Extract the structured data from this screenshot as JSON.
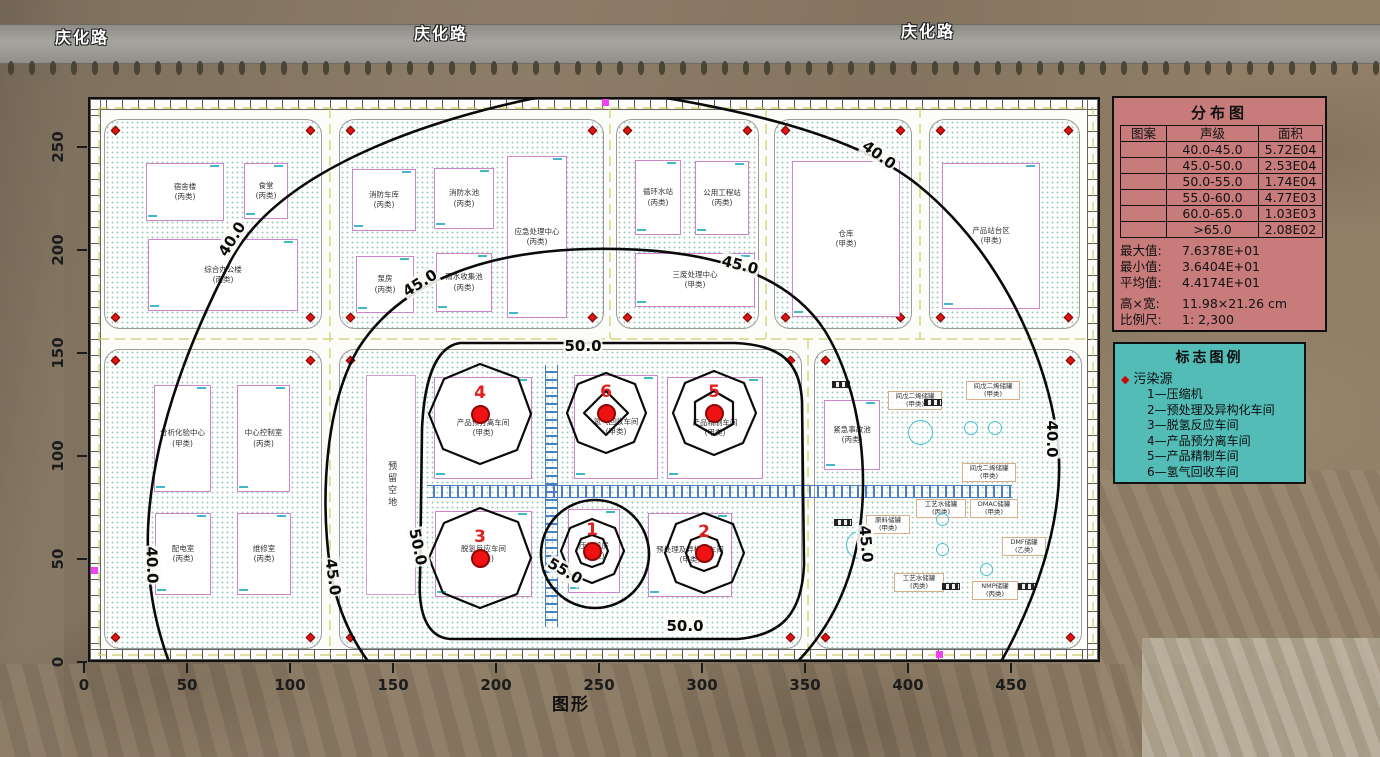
{
  "road_labels": [
    {
      "text": "庆化路",
      "x": 55,
      "y": 24
    },
    {
      "text": "庆化路",
      "x": 414,
      "y": 20
    },
    {
      "text": "庆化路",
      "x": 901,
      "y": 18
    }
  ],
  "axes": {
    "x_ticks": [
      0,
      50,
      100,
      150,
      200,
      250,
      300,
      350,
      400,
      450
    ],
    "y_ticks": [
      0,
      50,
      100,
      150,
      200,
      250
    ],
    "x_title": "图形"
  },
  "distribution": {
    "title": "分布图",
    "headers": [
      "图案",
      "声级",
      "面积"
    ],
    "rows": [
      {
        "pattern": "",
        "level": "40.0-45.0",
        "area": "5.72E04"
      },
      {
        "pattern": "",
        "level": "45.0-50.0",
        "area": "2.53E04"
      },
      {
        "pattern": "",
        "level": "50.0-55.0",
        "area": "1.74E04"
      },
      {
        "pattern": "",
        "level": "55.0-60.0",
        "area": "4.77E03"
      },
      {
        "pattern": "",
        "level": "60.0-65.0",
        "area": "1.03E03"
      },
      {
        "pattern": "",
        "level": ">65.0",
        "area": "2.08E02"
      }
    ],
    "stats": [
      {
        "label": "最大值:",
        "value": "7.6378E+01"
      },
      {
        "label": "最小值:",
        "value": "3.6404E+01"
      },
      {
        "label": "平均值:",
        "value": "4.4174E+01"
      }
    ],
    "dims": [
      {
        "label": "高×宽:",
        "value": "11.98×21.26 cm"
      },
      {
        "label": "比例尺:",
        "value": "1: 2,300"
      }
    ]
  },
  "marker_legend": {
    "title": "标志图例",
    "group": "污染源",
    "items": [
      "1—压缩机",
      "2—预处理及异构化车间",
      "3—脱氢反应车间",
      "4—产品预分离车间",
      "5—产品精制车间",
      "6—氢气回收车间"
    ]
  },
  "map": {
    "contour_labels": [
      {
        "text": "40.0",
        "x": 142,
        "y": 140,
        "rot": -58
      },
      {
        "text": "45.0",
        "x": 330,
        "y": 184,
        "rot": -32
      },
      {
        "text": "40.0",
        "x": 789,
        "y": 56,
        "rot": 36
      },
      {
        "text": "45.0",
        "x": 650,
        "y": 166,
        "rot": 14
      },
      {
        "text": "50.0",
        "x": 493,
        "y": 247,
        "rot": 0
      },
      {
        "text": "50.0",
        "x": 595,
        "y": 527,
        "rot": 0
      },
      {
        "text": "50.0",
        "x": 328,
        "y": 448,
        "rot": 78
      },
      {
        "text": "55.0",
        "x": 475,
        "y": 472,
        "rot": 30
      },
      {
        "text": "45.0",
        "x": 243,
        "y": 478,
        "rot": 82
      },
      {
        "text": "40.0",
        "x": 62,
        "y": 466,
        "rot": 88
      },
      {
        "text": "45.0",
        "x": 776,
        "y": 445,
        "rot": 85
      },
      {
        "text": "40.0",
        "x": 962,
        "y": 340,
        "rot": 90
      }
    ],
    "sources": [
      {
        "id": "4",
        "x": 390,
        "y": 315
      },
      {
        "id": "6",
        "x": 516,
        "y": 314
      },
      {
        "id": "5",
        "x": 624,
        "y": 314
      },
      {
        "id": "3",
        "x": 390,
        "y": 459
      },
      {
        "id": "1",
        "x": 502,
        "y": 452
      },
      {
        "id": "2",
        "x": 614,
        "y": 454
      }
    ],
    "buildings": [
      {
        "name": "宿舍楼",
        "cls": "(丙类)",
        "x": 56,
        "y": 64,
        "w": 78,
        "h": 58,
        "kind": "b"
      },
      {
        "name": "食堂",
        "cls": "(丙类)",
        "x": 154,
        "y": 64,
        "w": 44,
        "h": 56,
        "kind": "b"
      },
      {
        "name": "综合办公楼",
        "cls": "(丙类)",
        "x": 58,
        "y": 140,
        "w": 150,
        "h": 72,
        "kind": "b"
      },
      {
        "name": "消防车库",
        "cls": "(丙类)",
        "x": 262,
        "y": 70,
        "w": 64,
        "h": 62,
        "kind": "b"
      },
      {
        "name": "消防水池",
        "cls": "(丙类)",
        "x": 344,
        "y": 69,
        "w": 60,
        "h": 61,
        "kind": "b"
      },
      {
        "name": "泵房",
        "cls": "(丙类)",
        "x": 266,
        "y": 157,
        "w": 58,
        "h": 57,
        "kind": "b"
      },
      {
        "name": "雨水收集池",
        "cls": "(丙类)",
        "x": 346,
        "y": 154,
        "w": 56,
        "h": 59,
        "kind": "b"
      },
      {
        "name": "应急处理中心",
        "cls": "(丙类)",
        "x": 417,
        "y": 57,
        "w": 60,
        "h": 162,
        "kind": "b"
      },
      {
        "name": "循环水站",
        "cls": "(丙类)",
        "x": 545,
        "y": 61,
        "w": 46,
        "h": 75,
        "kind": "b"
      },
      {
        "name": "公用工程站",
        "cls": "(丙类)",
        "x": 605,
        "y": 62,
        "w": 54,
        "h": 74,
        "kind": "b"
      },
      {
        "name": "三废处理中心",
        "cls": "(甲类)",
        "x": 545,
        "y": 154,
        "w": 120,
        "h": 54,
        "kind": "b"
      },
      {
        "name": "仓库",
        "cls": "(甲类)",
        "x": 702,
        "y": 62,
        "w": 108,
        "h": 156,
        "kind": "b"
      },
      {
        "name": "产品站台区",
        "cls": "(甲类)",
        "x": 852,
        "y": 64,
        "w": 98,
        "h": 146,
        "kind": "b"
      },
      {
        "name": "分析化验中心",
        "cls": "(甲类)",
        "x": 64,
        "y": 286,
        "w": 57,
        "h": 107,
        "kind": "b"
      },
      {
        "name": "中心控制室",
        "cls": "(丙类)",
        "x": 147,
        "y": 286,
        "w": 53,
        "h": 107,
        "kind": "b"
      },
      {
        "name": "配电室",
        "cls": "(丙类)",
        "x": 65,
        "y": 414,
        "w": 56,
        "h": 82,
        "kind": "b"
      },
      {
        "name": "维修室",
        "cls": "(丙类)",
        "x": 147,
        "y": 414,
        "w": 54,
        "h": 82,
        "kind": "b"
      },
      {
        "name": "预留空地",
        "cls": "",
        "x": 276,
        "y": 276,
        "w": 50,
        "h": 220,
        "kind": "v"
      },
      {
        "name": "产品预分离车间",
        "cls": "(甲类)",
        "x": 344,
        "y": 278,
        "w": 98,
        "h": 102,
        "kind": "b"
      },
      {
        "name": "氢气回收车间",
        "cls": "(甲类)",
        "x": 484,
        "y": 276,
        "w": 84,
        "h": 104,
        "kind": "b"
      },
      {
        "name": "产品精制车间",
        "cls": "(甲类)",
        "x": 577,
        "y": 278,
        "w": 96,
        "h": 102,
        "kind": "b"
      },
      {
        "name": "脱氢反应车间",
        "cls": "(甲类)",
        "x": 345,
        "y": 412,
        "w": 97,
        "h": 86,
        "kind": "b"
      },
      {
        "name": "压缩机房",
        "cls": "(甲类)",
        "x": 478,
        "y": 410,
        "w": 52,
        "h": 84,
        "kind": "b"
      },
      {
        "name": "预处理及异构化车间",
        "cls": "(甲类)",
        "x": 558,
        "y": 414,
        "w": 84,
        "h": 84,
        "kind": "b"
      },
      {
        "name": "紧急事故池",
        "cls": "(丙类)",
        "x": 734,
        "y": 301,
        "w": 56,
        "h": 70,
        "kind": "b"
      },
      {
        "name": "间戊二烯储罐",
        "cls": "(甲类)",
        "x": 798,
        "y": 292,
        "w": 54,
        "h": 22,
        "kind": "t"
      },
      {
        "name": "间戊二烯储罐",
        "cls": "(甲类)",
        "x": 876,
        "y": 282,
        "w": 54,
        "h": 22,
        "kind": "t"
      },
      {
        "name": "间戊二烯储罐",
        "cls": "(甲类)",
        "x": 872,
        "y": 364,
        "w": 54,
        "h": 22,
        "kind": "t"
      },
      {
        "name": "原料储罐",
        "cls": "(甲类)",
        "x": 776,
        "y": 416,
        "w": 44,
        "h": 22,
        "kind": "t"
      },
      {
        "name": "工艺水储罐",
        "cls": "(丙类)",
        "x": 826,
        "y": 400,
        "w": 50,
        "h": 22,
        "kind": "t"
      },
      {
        "name": "工艺水储罐",
        "cls": "(丙类)",
        "x": 804,
        "y": 474,
        "w": 50,
        "h": 22,
        "kind": "t"
      },
      {
        "name": "DMAC储罐",
        "cls": "(甲类)",
        "x": 880,
        "y": 400,
        "w": 48,
        "h": 22,
        "kind": "t"
      },
      {
        "name": "DMF储罐",
        "cls": "(乙类)",
        "x": 912,
        "y": 438,
        "w": 44,
        "h": 22,
        "kind": "t"
      },
      {
        "name": "NMP储罐",
        "cls": "(丙类)",
        "x": 882,
        "y": 482,
        "w": 46,
        "h": 22,
        "kind": "t"
      }
    ],
    "colors": {
      "contour": "#0a0a0a",
      "source": "#ee1212",
      "source_number": "#e02020",
      "dist_box": "#c87b7b",
      "legend_box": "#53bcb7",
      "building_outline": "#cc85cc",
      "railway": "#4a7fc1"
    }
  }
}
